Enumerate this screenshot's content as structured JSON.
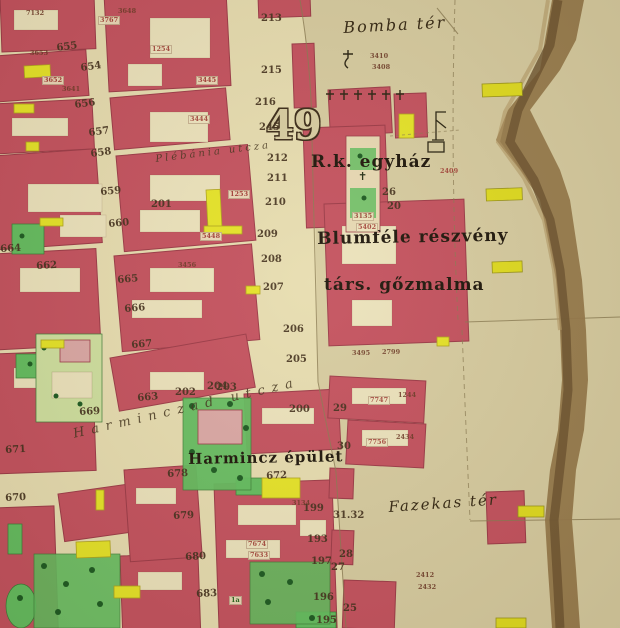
{
  "map": {
    "sheet_number": "49",
    "colors": {
      "parchment": "#d2c396",
      "square": "#d7cca1",
      "street": "#e7ddb1",
      "court": "#ece3bd",
      "red": "#c4515f",
      "red_border": "#9c3a48",
      "pink": "#dba8a6",
      "yellow": "#e6e428",
      "green": "#63bd60",
      "tree": "#1c5a22",
      "river": "#96794c",
      "river_dark": "#6b5330",
      "ink": "#3a2a18",
      "red_ink": "#a03d35",
      "green_ink": "#1a6a1a"
    },
    "place_labels": [
      {
        "t": "Bomba tér",
        "n": "bomba-ter-label",
        "cls": "place-italic",
        "x": 343,
        "y": 20,
        "s": 16,
        "r": -3
      },
      {
        "t": "R.k. egyház",
        "n": "rk-egyhaz-label",
        "cls": "place-bold",
        "x": 311,
        "y": 154,
        "s": 17,
        "r": 0
      },
      {
        "t": "Blumféle részvény",
        "n": "blumfele-reszveny-label",
        "cls": "place-bold",
        "x": 317,
        "y": 231,
        "s": 17,
        "r": -1
      },
      {
        "t": "társ. gőzmalma",
        "n": "tars-gozmalma-label",
        "cls": "place-bold",
        "x": 324,
        "y": 277,
        "s": 17,
        "r": 0
      },
      {
        "t": "Harmincz épület",
        "n": "harmincz-epulet-label",
        "cls": "place-bold",
        "x": 188,
        "y": 452,
        "s": 15,
        "r": -1
      },
      {
        "t": "Fazekas tér",
        "n": "fazekas-ter-label",
        "cls": "place-italic",
        "x": 388,
        "y": 500,
        "s": 15,
        "r": -4
      },
      {
        "t": "49",
        "n": "sheet-number-label",
        "cls": "sheet",
        "x": 266,
        "y": 106,
        "s": 40,
        "r": 0
      }
    ],
    "street_labels": [
      {
        "t": "Plébánia utcza",
        "n": "plebania-utcza-label",
        "x": 155,
        "y": 155,
        "s": 10,
        "r": -7,
        "ls": 3
      },
      {
        "t": "Harminczad utcza",
        "n": "harminczad-utcza-label",
        "x": 72,
        "y": 428,
        "s": 13,
        "r": -13,
        "ls": 7
      }
    ],
    "house_numbers": [
      {
        "t": "655",
        "x": 56,
        "y": 44,
        "r": -8
      },
      {
        "t": "654",
        "x": 80,
        "y": 64,
        "r": -8
      },
      {
        "t": "656",
        "x": 74,
        "y": 101,
        "r": -8
      },
      {
        "t": "657",
        "x": 88,
        "y": 129,
        "r": -8
      },
      {
        "t": "658",
        "x": 90,
        "y": 150,
        "r": -8
      },
      {
        "t": "659",
        "x": 100,
        "y": 188,
        "r": -5
      },
      {
        "t": "660",
        "x": 108,
        "y": 220,
        "r": -5
      },
      {
        "t": "662",
        "x": 36,
        "y": 262,
        "r": -3
      },
      {
        "t": "664",
        "x": 0,
        "y": 245,
        "r": -3
      },
      {
        "t": "665",
        "x": 117,
        "y": 276,
        "r": -5
      },
      {
        "t": "666",
        "x": 124,
        "y": 305,
        "r": -5
      },
      {
        "t": "667",
        "x": 131,
        "y": 341,
        "r": -5
      },
      {
        "t": "663",
        "x": 137,
        "y": 394,
        "r": -5
      },
      {
        "t": "669",
        "x": 79,
        "y": 408,
        "r": -3
      },
      {
        "t": "671",
        "x": 5,
        "y": 446,
        "r": -3
      },
      {
        "t": "670",
        "x": 5,
        "y": 494,
        "r": -3
      },
      {
        "t": "678",
        "x": 167,
        "y": 470,
        "r": -3
      },
      {
        "t": "679",
        "x": 173,
        "y": 512,
        "r": -3
      },
      {
        "t": "680",
        "x": 185,
        "y": 553,
        "r": -3
      },
      {
        "t": "683",
        "x": 196,
        "y": 590,
        "r": -3
      },
      {
        "t": "672",
        "x": 266,
        "y": 472,
        "r": -3
      },
      {
        "t": "213",
        "x": 261,
        "y": 14,
        "r": 0
      },
      {
        "t": "215",
        "x": 261,
        "y": 66,
        "r": 0
      },
      {
        "t": "216",
        "x": 255,
        "y": 98,
        "r": 0
      },
      {
        "t": "245",
        "x": 259,
        "y": 123,
        "r": 0
      },
      {
        "t": "212",
        "x": 267,
        "y": 154,
        "r": 0
      },
      {
        "t": "211",
        "x": 267,
        "y": 174,
        "r": 0
      },
      {
        "t": "210",
        "x": 265,
        "y": 198,
        "r": 0
      },
      {
        "t": "209",
        "x": 257,
        "y": 230,
        "r": 0
      },
      {
        "t": "208",
        "x": 261,
        "y": 255,
        "r": 0
      },
      {
        "t": "207",
        "x": 263,
        "y": 283,
        "r": 0
      },
      {
        "t": "206",
        "x": 283,
        "y": 325,
        "r": 0
      },
      {
        "t": "205",
        "x": 286,
        "y": 355,
        "r": 0
      },
      {
        "t": "204",
        "x": 207,
        "y": 382,
        "r": 0
      },
      {
        "t": "203",
        "x": 216,
        "y": 383,
        "r": 0
      },
      {
        "t": "202",
        "x": 175,
        "y": 388,
        "r": 0
      },
      {
        "t": "201",
        "x": 151,
        "y": 200,
        "r": 0
      },
      {
        "t": "200",
        "x": 289,
        "y": 405,
        "r": 0
      },
      {
        "t": "199",
        "x": 303,
        "y": 504,
        "r": 0
      },
      {
        "t": "193",
        "x": 307,
        "y": 535,
        "r": 0
      },
      {
        "t": "197",
        "x": 311,
        "y": 557,
        "r": 0
      },
      {
        "t": "196",
        "x": 313,
        "y": 593,
        "r": 0
      },
      {
        "t": "195",
        "x": 316,
        "y": 616,
        "r": 0
      },
      {
        "t": "26",
        "x": 382,
        "y": 188,
        "r": 0
      },
      {
        "t": "20",
        "x": 387,
        "y": 202,
        "r": 0
      },
      {
        "t": "29",
        "x": 333,
        "y": 404,
        "r": 0
      },
      {
        "t": "30",
        "x": 337,
        "y": 442,
        "r": 0
      },
      {
        "t": "31.32",
        "x": 333,
        "y": 511,
        "r": 0
      },
      {
        "t": "28",
        "x": 339,
        "y": 550,
        "r": 0
      },
      {
        "t": "27",
        "x": 331,
        "y": 563,
        "r": 0
      },
      {
        "t": "25",
        "x": 343,
        "y": 604,
        "r": 0
      }
    ],
    "parcel_numbers": [
      {
        "t": "7132",
        "x": 26,
        "y": 10
      },
      {
        "t": "3648",
        "x": 118,
        "y": 8
      },
      {
        "t": "3767",
        "x": 98,
        "y": 16,
        "bg": 1
      },
      {
        "t": "3653",
        "x": 30,
        "y": 50
      },
      {
        "t": "3652",
        "x": 42,
        "y": 76,
        "bg": 1
      },
      {
        "t": "3641",
        "x": 62,
        "y": 86
      },
      {
        "t": "1254",
        "x": 150,
        "y": 45,
        "bg": 1
      },
      {
        "t": "3445",
        "x": 196,
        "y": 76,
        "bg": 1
      },
      {
        "t": "3444",
        "x": 188,
        "y": 115,
        "bg": 1
      },
      {
        "t": "3410",
        "x": 370,
        "y": 53
      },
      {
        "t": "3408",
        "x": 372,
        "y": 64
      },
      {
        "t": "2409",
        "x": 440,
        "y": 168,
        "c": "red_ink"
      },
      {
        "t": "1253",
        "x": 228,
        "y": 190,
        "bg": 1
      },
      {
        "t": "5448",
        "x": 200,
        "y": 232,
        "bg": 1
      },
      {
        "t": "3456",
        "x": 178,
        "y": 262
      },
      {
        "t": "3135",
        "x": 352,
        "y": 212,
        "bg": 1
      },
      {
        "t": "5402",
        "x": 356,
        "y": 223,
        "bg": 1
      },
      {
        "t": "3495",
        "x": 352,
        "y": 350
      },
      {
        "t": "2799",
        "x": 382,
        "y": 349
      },
      {
        "t": "7747",
        "x": 368,
        "y": 396,
        "bg": 1
      },
      {
        "t": "1244",
        "x": 398,
        "y": 392
      },
      {
        "t": "7756",
        "x": 366,
        "y": 438,
        "bg": 1
      },
      {
        "t": "2434",
        "x": 396,
        "y": 434
      },
      {
        "t": "2412",
        "x": 416,
        "y": 572
      },
      {
        "t": "2432",
        "x": 418,
        "y": 584
      },
      {
        "t": "7674",
        "x": 246,
        "y": 540,
        "bg": 1
      },
      {
        "t": "7633",
        "x": 248,
        "y": 551,
        "bg": 1
      },
      {
        "t": "3134",
        "x": 292,
        "y": 500
      },
      {
        "t": "1a",
        "x": 229,
        "y": 596,
        "c": "green_ink",
        "bg": 1
      }
    ]
  }
}
